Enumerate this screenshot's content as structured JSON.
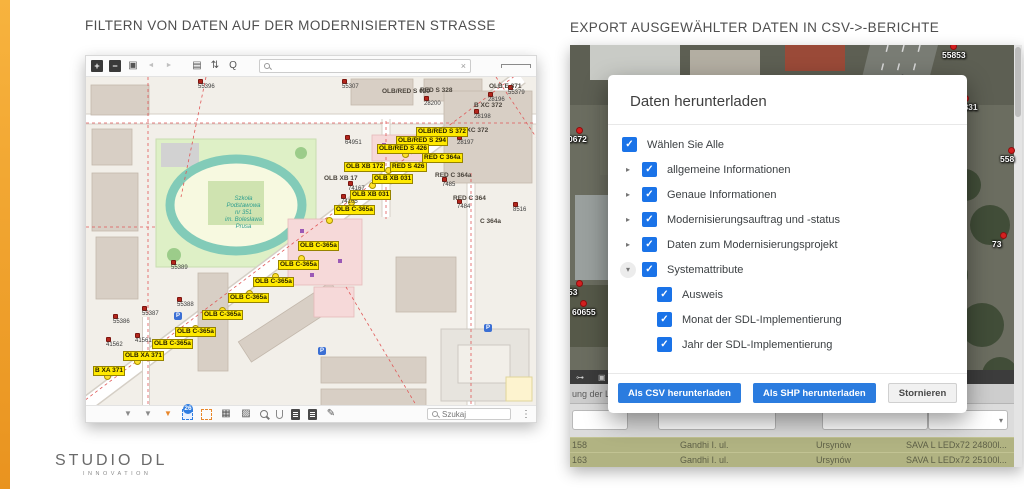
{
  "page": {
    "left_title": "FILTERN VON DATEN AUF DER MODERNISIERTEN STRASSE",
    "right_title": "EXPORT AUSGEWÄHLTER DATEN IN CSV->-BERICHTE",
    "logo_line1": "STUDIO DL",
    "logo_line2": "INNOVATION",
    "accent_color": "#F2A33C"
  },
  "map_window": {
    "top_toolbar": {
      "search_value": "",
      "clear_icon": "×",
      "icons": [
        {
          "name": "zoom-in-icon",
          "glyph": "+",
          "cls": "sq"
        },
        {
          "name": "zoom-out-icon",
          "glyph": "−",
          "cls": "sq"
        },
        {
          "name": "fullscreen-icon",
          "glyph": "▣",
          "cls": "plain"
        },
        {
          "name": "prev-view-icon",
          "glyph": "◄",
          "cls": "dim"
        },
        {
          "name": "next-view-icon",
          "glyph": "►",
          "cls": "dim"
        },
        {
          "name": "print-icon",
          "glyph": "▤",
          "cls": "gap"
        },
        {
          "name": "sort-icon",
          "glyph": "⇅",
          "cls": "plain"
        },
        {
          "name": "zoom-search-icon",
          "glyph": "Q",
          "cls": "plain"
        }
      ]
    },
    "bottom_toolbar": {
      "selection_count": "26",
      "search_placeholder": "Szukaj",
      "menu_icon": "⋮",
      "icons": [
        {
          "name": "filter-icon",
          "glyph": "▼",
          "cls": "fun"
        },
        {
          "name": "filter-edit-icon",
          "glyph": "▼",
          "cls": "fun"
        },
        {
          "name": "filter-active-icon",
          "glyph": "▼",
          "cls": "fun orange"
        },
        {
          "name": "select-area-icon",
          "glyph": "",
          "cls": "dash blue"
        },
        {
          "name": "select-area-alt-icon",
          "glyph": "",
          "cls": "dash orange2"
        },
        {
          "name": "table-icon",
          "glyph": "▦",
          "cls": "plain"
        },
        {
          "name": "image-icon",
          "glyph": "▨",
          "cls": "plain"
        },
        {
          "name": "search-small-icon",
          "glyph": "",
          "cls": "lens"
        },
        {
          "name": "attachment-icon",
          "glyph": "",
          "cls": "clip"
        },
        {
          "name": "document-icon",
          "glyph": "",
          "cls": "doc"
        },
        {
          "name": "document-copy-icon",
          "glyph": "",
          "cls": "doc"
        },
        {
          "name": "edit-icon",
          "glyph": "✎",
          "cls": "plain"
        }
      ]
    },
    "map": {
      "school_lines": [
        "Szkoła",
        "Podstawowa",
        "nr 351",
        "im. Bolesława",
        "Prusa"
      ],
      "parking": [
        {
          "t": "P",
          "x": 88,
          "y": 235
        },
        {
          "t": "P",
          "x": 232,
          "y": 270
        },
        {
          "t": "P",
          "x": 398,
          "y": 247
        }
      ],
      "yellow_labels": [
        {
          "text": "OLB/RED S 372",
          "x": 330,
          "y": 50
        },
        {
          "text": "OLB/RED S 294",
          "x": 310,
          "y": 59
        },
        {
          "text": "OLB/RED S 426",
          "x": 291,
          "y": 67
        },
        {
          "text": "RED C 364a",
          "x": 336,
          "y": 76
        },
        {
          "text": "OLB XB 172",
          "x": 258,
          "y": 85
        },
        {
          "text": "RED S 426",
          "x": 304,
          "y": 85
        },
        {
          "text": "OLB XB 031",
          "x": 286,
          "y": 97
        },
        {
          "text": "OLB XB 031",
          "x": 264,
          "y": 113
        },
        {
          "text": "OLB C-365a",
          "x": 248,
          "y": 128
        },
        {
          "text": "OLB C-365a",
          "x": 212,
          "y": 164
        },
        {
          "text": "OLB C-365a",
          "x": 192,
          "y": 183
        },
        {
          "text": "OLB C-365a",
          "x": 167,
          "y": 200
        },
        {
          "text": "OLB C-365a",
          "x": 142,
          "y": 216
        },
        {
          "text": "OLB C-365a",
          "x": 116,
          "y": 233
        },
        {
          "text": "OLB C-365a",
          "x": 89,
          "y": 250
        },
        {
          "text": "OLB C-365a",
          "x": 66,
          "y": 262
        },
        {
          "text": "OLB XA 371",
          "x": 37,
          "y": 274
        },
        {
          "text": "B XA 371",
          "x": 7,
          "y": 289
        }
      ],
      "plain_labels": [
        {
          "text": "OLB E 371",
          "x": 403,
          "y": 6
        },
        {
          "text": "B XC 372",
          "x": 388,
          "y": 25
        },
        {
          "text": "OLB XC 372",
          "x": 365,
          "y": 50
        },
        {
          "text": "RED S 328",
          "x": 334,
          "y": 10
        },
        {
          "text": "OLB/RED S 020",
          "x": 296,
          "y": 11
        },
        {
          "text": "OLB XB 17",
          "x": 238,
          "y": 98
        },
        {
          "text": "RED C 364a",
          "x": 349,
          "y": 95
        },
        {
          "text": "RED C 364",
          "x": 367,
          "y": 118
        },
        {
          "text": "C 364a",
          "x": 394,
          "y": 141
        }
      ],
      "red_markers": [
        {
          "text": "55396",
          "x": 112,
          "y": 2
        },
        {
          "text": "55307",
          "x": 256,
          "y": 2
        },
        {
          "text": "55379",
          "x": 422,
          "y": 8
        },
        {
          "text": "28196",
          "x": 402,
          "y": 15
        },
        {
          "text": "28198",
          "x": 388,
          "y": 32
        },
        {
          "text": "28200",
          "x": 338,
          "y": 19
        },
        {
          "text": "28197",
          "x": 371,
          "y": 58
        },
        {
          "text": "64951",
          "x": 259,
          "y": 58
        },
        {
          "text": "7485",
          "x": 356,
          "y": 100
        },
        {
          "text": "7484",
          "x": 371,
          "y": 122
        },
        {
          "text": "8516",
          "x": 427,
          "y": 125
        },
        {
          "text": "74167",
          "x": 262,
          "y": 104
        },
        {
          "text": "74165",
          "x": 255,
          "y": 117
        },
        {
          "text": "55389",
          "x": 85,
          "y": 183
        },
        {
          "text": "55388",
          "x": 91,
          "y": 220
        },
        {
          "text": "55387",
          "x": 56,
          "y": 229
        },
        {
          "text": "55386",
          "x": 27,
          "y": 237
        },
        {
          "text": "41561",
          "x": 49,
          "y": 256
        },
        {
          "text": "41562",
          "x": 20,
          "y": 260
        }
      ],
      "yellow_dots": [
        {
          "x": 18,
          "y": 296
        },
        {
          "x": 48,
          "y": 281
        },
        {
          "x": 78,
          "y": 263
        },
        {
          "x": 106,
          "y": 248
        },
        {
          "x": 133,
          "y": 230
        },
        {
          "x": 160,
          "y": 213
        },
        {
          "x": 186,
          "y": 196
        },
        {
          "x": 212,
          "y": 178
        },
        {
          "x": 240,
          "y": 140
        },
        {
          "x": 262,
          "y": 122
        },
        {
          "x": 283,
          "y": 105
        },
        {
          "x": 299,
          "y": 90
        },
        {
          "x": 316,
          "y": 74
        },
        {
          "x": 328,
          "y": 61
        }
      ]
    }
  },
  "export_panel": {
    "dialog": {
      "title": "Daten herunterladen",
      "checkmark": "✓",
      "items": [
        {
          "label": "Wählen Sie Alle",
          "cls": "lvl0",
          "arrow": ""
        },
        {
          "label": "allgemeine Informationen",
          "cls": "lvl1",
          "arrow": "▸"
        },
        {
          "label": "Genaue Informationen",
          "cls": "lvl1",
          "arrow": "▸"
        },
        {
          "label": "Modernisierungsauftrag und -status",
          "cls": "lvl1",
          "arrow": "▸"
        },
        {
          "label": "Daten zum Modernisierungsprojekt",
          "cls": "lvl1",
          "arrow": "▸"
        },
        {
          "label": "Systemattribute",
          "cls": "lvl1 open",
          "arrow": "▾"
        },
        {
          "label": "Ausweis",
          "cls": "lvl2",
          "arrow": ""
        },
        {
          "label": "Monat der SDL-Implementierung",
          "cls": "lvl2",
          "arrow": ""
        },
        {
          "label": "Jahr der SDL-Implementierung",
          "cls": "lvl2",
          "arrow": ""
        }
      ],
      "buttons": {
        "csv": "Als CSV herunterladen",
        "shp": "Als SHP herunterladen",
        "cancel": "Stornieren"
      }
    },
    "background": {
      "sat_markers": [
        {
          "text": "55853",
          "x": 372,
          "y": -2
        },
        {
          "text": "55831",
          "x": 384,
          "y": 50
        },
        {
          "text": "558",
          "x": 430,
          "y": 102
        },
        {
          "text": "73",
          "x": 422,
          "y": 187
        },
        {
          "text": "0672",
          "x": -2,
          "y": 82
        },
        {
          "text": "53",
          "x": -2,
          "y": 235
        },
        {
          "text": "60655",
          "x": 2,
          "y": 255
        }
      ],
      "strip_icons": [
        {
          "name": "link-icon",
          "glyph": "⊶"
        },
        {
          "name": "layers-icon",
          "glyph": "▣"
        }
      ],
      "table": {
        "header_left": "ung der Le",
        "header_right": "atalog",
        "dropdown_arrow": "▾",
        "rows": [
          [
            "158",
            "Gandhi I. ul.",
            "Ursynów",
            "SAVA L LEDx72 24800l..."
          ],
          [
            "163",
            "Gandhi I. ul.",
            "Ursynów",
            "SAVA L LEDx72 25100l..."
          ]
        ]
      }
    }
  }
}
